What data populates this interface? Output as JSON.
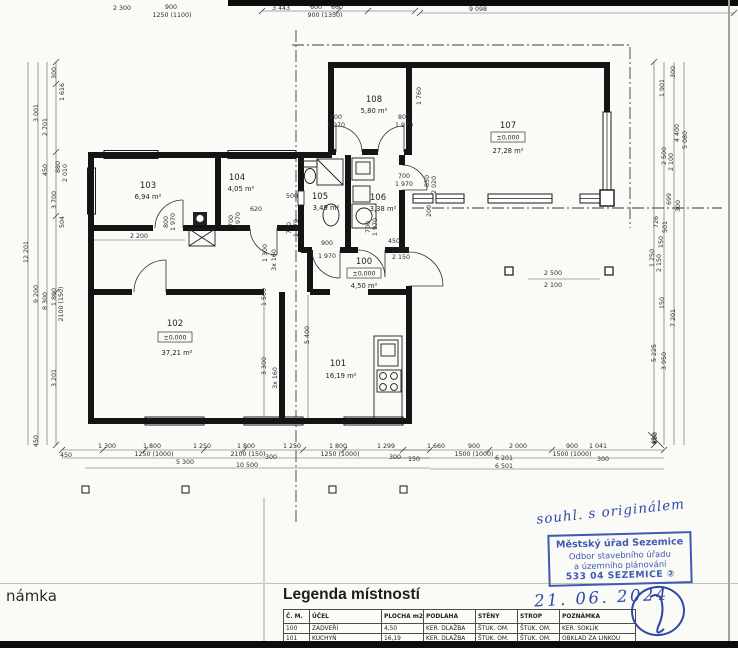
{
  "rooms": [
    {
      "number": "100",
      "level": "±0,000",
      "area": "4,50 m²"
    },
    {
      "number": "101",
      "area": "16,19 m²"
    },
    {
      "number": "102",
      "level": "±0,000",
      "area": "37,21 m²"
    },
    {
      "number": "103",
      "area": "6,94 m²"
    },
    {
      "number": "104",
      "area": "4,05 m²"
    },
    {
      "number": "105",
      "area": "3,49 m²"
    },
    {
      "number": "106",
      "area": "3,38 m²"
    },
    {
      "number": "107",
      "level": "±0,000",
      "area": "27,28 m²"
    },
    {
      "number": "108",
      "area": "5,80 m²"
    }
  ],
  "dims": {
    "top": [
      "2 300",
      "900",
      "1250 (1100)",
      "3 443",
      "600",
      "660",
      "900 (1350)",
      "9 098"
    ],
    "left": [
      "300",
      "1 616",
      "3 001",
      "2 701",
      "880",
      "2 010",
      "450",
      "504",
      "3 700",
      "9 200",
      "8 300",
      "1 800",
      "2100 (150)",
      "3 201",
      "450",
      "12 201"
    ],
    "right": [
      "300",
      "1 901",
      "4 400",
      "5 080",
      "2 500",
      "2 100",
      "699",
      "300",
      "726",
      "501",
      "150",
      "1 250",
      "2 150",
      "150",
      "7 201",
      "5 225",
      "3 950",
      "450"
    ],
    "bottom": [
      "450",
      "1 300",
      "1 800",
      "1250 (1000)",
      "1 250",
      "1 800",
      "2100 (150)",
      "5 300",
      "300",
      "1 250",
      "1 800",
      "1250 (1000)",
      "1 299",
      "300",
      "10 500",
      "150",
      "1 660",
      "900",
      "1500 (1000)",
      "2 000",
      "6 201",
      "900",
      "1500 (1000)",
      "1 041",
      "300",
      "6 501",
      "450"
    ],
    "interior": [
      "800",
      "1 970",
      "2 200",
      "700",
      "1 970",
      "620",
      "1 300",
      "3x 160",
      "500",
      "800",
      "1 970",
      "800",
      "1 970",
      "1 760",
      "700",
      "1 970",
      "850",
      "2 020",
      "200",
      "900",
      "1 970",
      "450",
      "1 250",
      "2 150",
      "700",
      "1 970",
      "700",
      "1 970",
      "5 400",
      "1 500",
      "3 300",
      "3x 160",
      "2 500",
      "2 100"
    ]
  },
  "legend": {
    "title": "Legenda místností",
    "columns": [
      "Č. M.",
      "ÚČEL",
      "PLOCHA m2",
      "PODLAHA",
      "STĚNY",
      "STROP",
      "POZNÁMKA"
    ],
    "rows": [
      [
        "100",
        "ZÁDVEŘÍ",
        "4,50",
        "KER. DLAŽBA",
        "ŠTUK. OM.",
        "ŠTUK. OM.",
        "KER. SOKLÍK"
      ],
      [
        "101",
        "KUCHYŇ",
        "16,19",
        "KER. DLAŽBA",
        "ŠTUK. OM.",
        "ŠTUK. OM.",
        "OBKLAD ZA LINKOU"
      ]
    ]
  },
  "footer": {
    "left_label": "námka"
  },
  "stamp": {
    "line1": "Městský úřad Sezemice",
    "line2": "Odbor stavebního úřadu",
    "line3": "a územního plánování",
    "line4": "533 04 SEZEMICE",
    "badge": "②"
  },
  "handwriting": {
    "note": "souhl. s originálem",
    "date": "21. 06. 2024"
  },
  "colors": {
    "stamp_blue": "#4059b3",
    "ink_blue": "#3246a8",
    "line": "#1a1a1a"
  }
}
